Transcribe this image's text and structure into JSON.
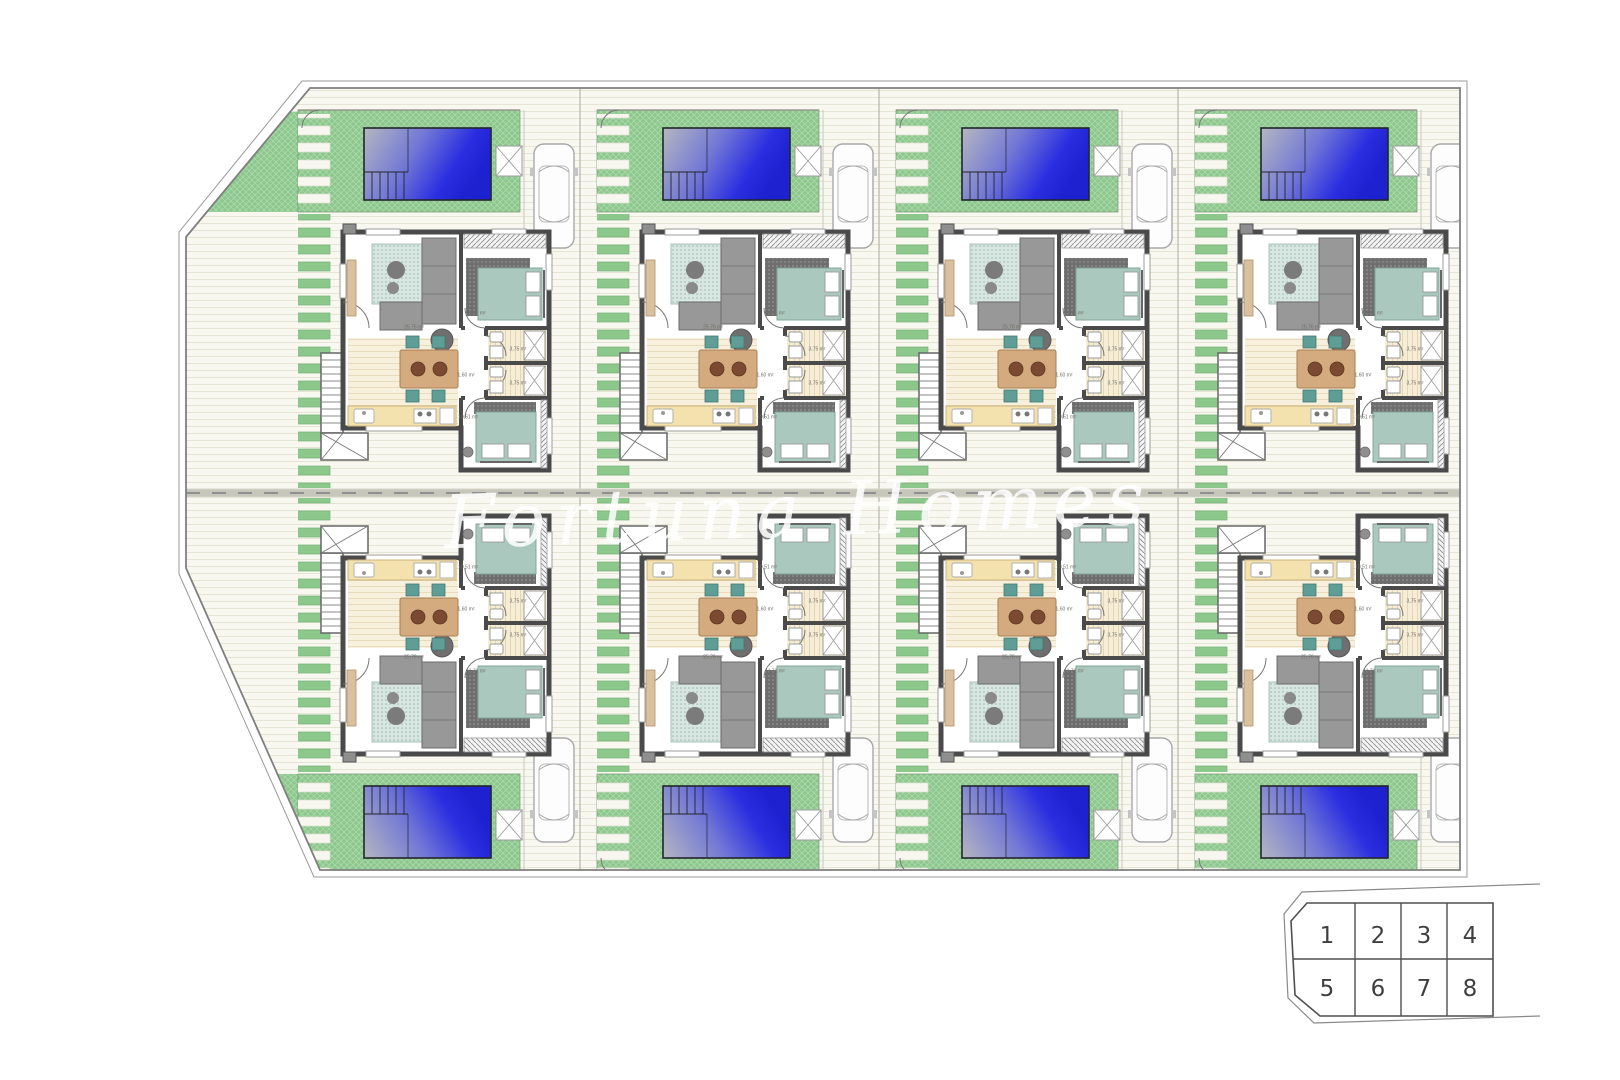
{
  "plan": {
    "title": "Residential site plan — 8 semi-detached villas with private pools",
    "watermark": {
      "text": "Fortuna Homes"
    },
    "key_plan": {
      "cells": [
        "1",
        "2",
        "3",
        "4",
        "5",
        "6",
        "7",
        "8"
      ]
    },
    "unit": {
      "labels": {
        "living": "25,76 m²",
        "bedroom_front": "11,71 m²",
        "bedroom_rear": "10,51 m²",
        "bath_a": "3,75 m²",
        "bath_b": "3,75 m²",
        "hall": "1,60 m²"
      }
    },
    "colors": {
      "grass": "#8cc88c",
      "paving": "#f8f8f1",
      "paving_line": "#e5e5d6",
      "pool_deep": "#2a2ee0",
      "pool_shallow": "#b4b7bf",
      "wall": "#4a4a4a",
      "bed_duvet": "#abc8be",
      "kitchen_counter": "#f4e2ae",
      "dining_table": "#d3ab7f",
      "chair": "#5f9d97",
      "sofa": "#989898",
      "boundary": "#7f7f7f"
    }
  }
}
